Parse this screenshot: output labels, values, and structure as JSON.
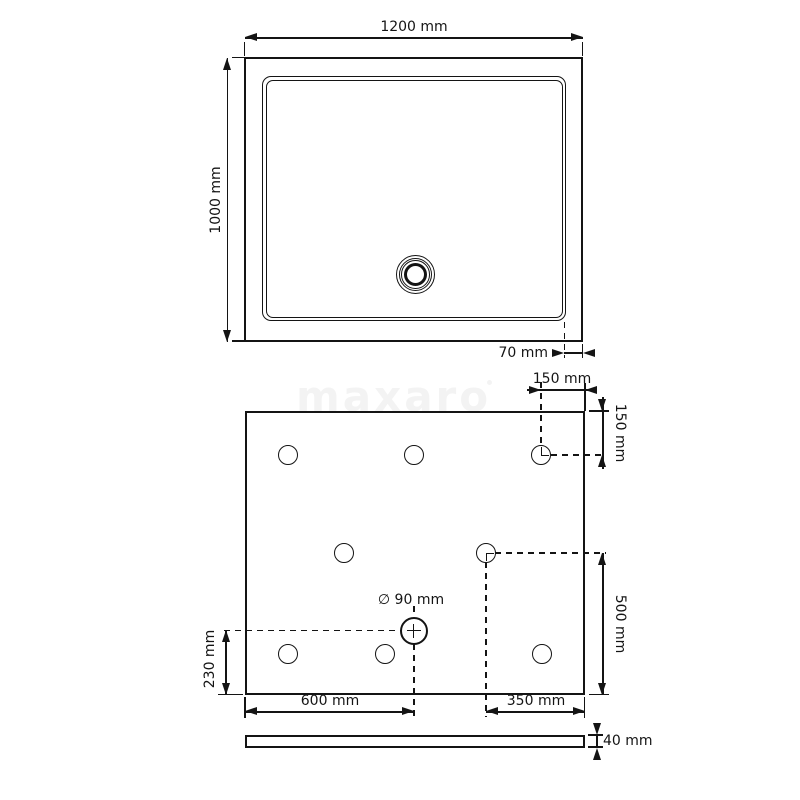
{
  "watermark": {
    "text": "maxaro"
  },
  "colors": {
    "line": "#141414",
    "watermark": "#f3f3f3",
    "background": "#ffffff"
  },
  "top_view": {
    "width_label": "1200 mm",
    "height_label": "1000 mm",
    "rim_label": "70 mm"
  },
  "bottom_view": {
    "corner_offset_x_label": "150 mm",
    "corner_offset_y_label": "150 mm",
    "drain_diameter_label": "∅ 90 mm",
    "support_offset_y_label": "500 mm",
    "drain_offset_y_label": "230 mm",
    "drain_offset_x_label": "600 mm",
    "support_offset_x_label": "350 mm"
  },
  "side_view": {
    "thickness_label": "40 mm"
  }
}
